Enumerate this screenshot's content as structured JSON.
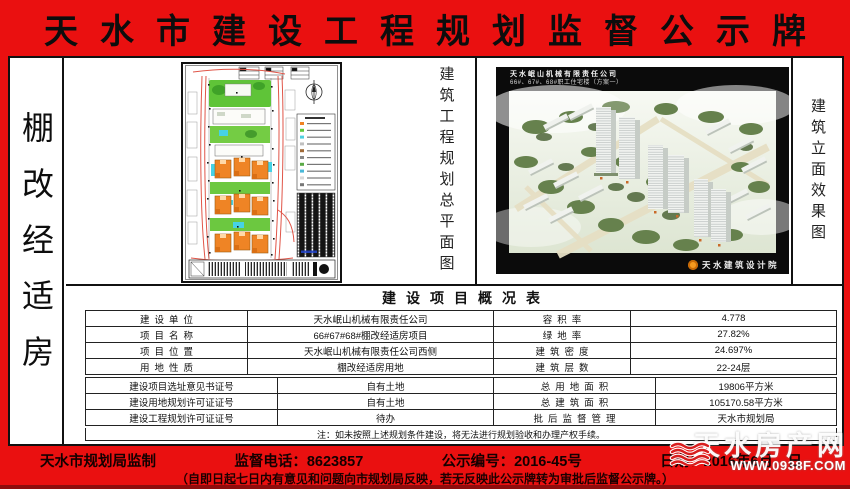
{
  "banner": {
    "title": "天水市建设工程规划监督公示牌"
  },
  "left_strip": {
    "label": "棚改经适房"
  },
  "plan_section": {
    "caption": "建筑工程规划总平面图"
  },
  "render_section": {
    "caption": "建筑立面效果图",
    "title_line1": "天水岷山机械有限责任公司",
    "title_line2": "66#、67#、68#职工住宅楼（方案一）",
    "designer": "天水建筑设计院"
  },
  "table": {
    "title": "建设项目概况表",
    "top_rows": [
      {
        "c0": "建设单位",
        "c1": "天水岷山机械有限责任公司",
        "c2": "容积率",
        "c3": "4.778"
      },
      {
        "c0": "项目名称",
        "c1": "66#67#68#棚改经适房项目",
        "c2": "绿地率",
        "c3": "27.82%"
      },
      {
        "c0": "项目位置",
        "c1": "天水岷山机械有限责任公司西侧",
        "c2": "建筑密度",
        "c3": "24.697%"
      },
      {
        "c0": "用地性质",
        "c1": "棚改经适房用地",
        "c2": "建筑层数",
        "c3": "22-24层"
      }
    ],
    "bottom_rows": [
      {
        "c0": "建设项目选址意见书证号",
        "c1": "自有土地",
        "c2": "总用地面积",
        "c3": "19806平方米"
      },
      {
        "c0": "建设用地规划许可证证号",
        "c1": "自有土地",
        "c2": "总建筑面积",
        "c3": "105170.58平方米"
      },
      {
        "c0": "建设工程规划许可证证号",
        "c1": "待办",
        "c2": "批后监督管理",
        "c3": "天水市规划局"
      }
    ],
    "note": "注：如未按照上述规划条件建设，将无法进行规划验收和办理产权手续。"
  },
  "footer": {
    "issuer": "天水市规划局监制",
    "phone": "监督电话：8623857",
    "notice_no": "公示编号：2016-45号",
    "date": "日期：2016年6月　日",
    "line2": "（自即日起七日内有意见和问题向市规划局反映，若无反映此公示牌转为审批后监督公示牌。）"
  },
  "watermark": {
    "site_name": "天水房产网",
    "url": "WWW.0938F.COM"
  },
  "colors": {
    "plate_red": "#ea1010",
    "accent_orange": "#ef8425",
    "green": "#5fc438"
  }
}
